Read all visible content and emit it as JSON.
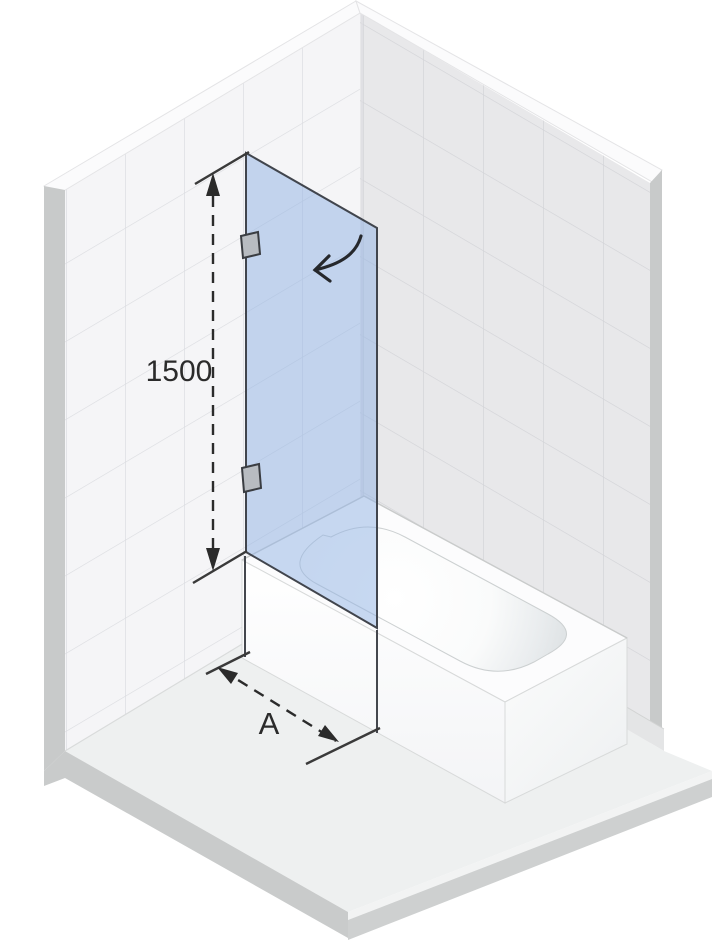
{
  "dimensions": {
    "height": {
      "label": "1500"
    },
    "width": {
      "label": "A"
    }
  },
  "colors": {
    "glass_fill": "#8fb2e4",
    "glass_outline": "#41454d",
    "dimension_ink": "#2b2b2b",
    "left_wall": "#f5f5f7",
    "right_wall": "#e8e8ea",
    "floor": "#eef0f0",
    "tub_white": "#fcfcfd",
    "hinge_fill": "#b8bcc1"
  }
}
